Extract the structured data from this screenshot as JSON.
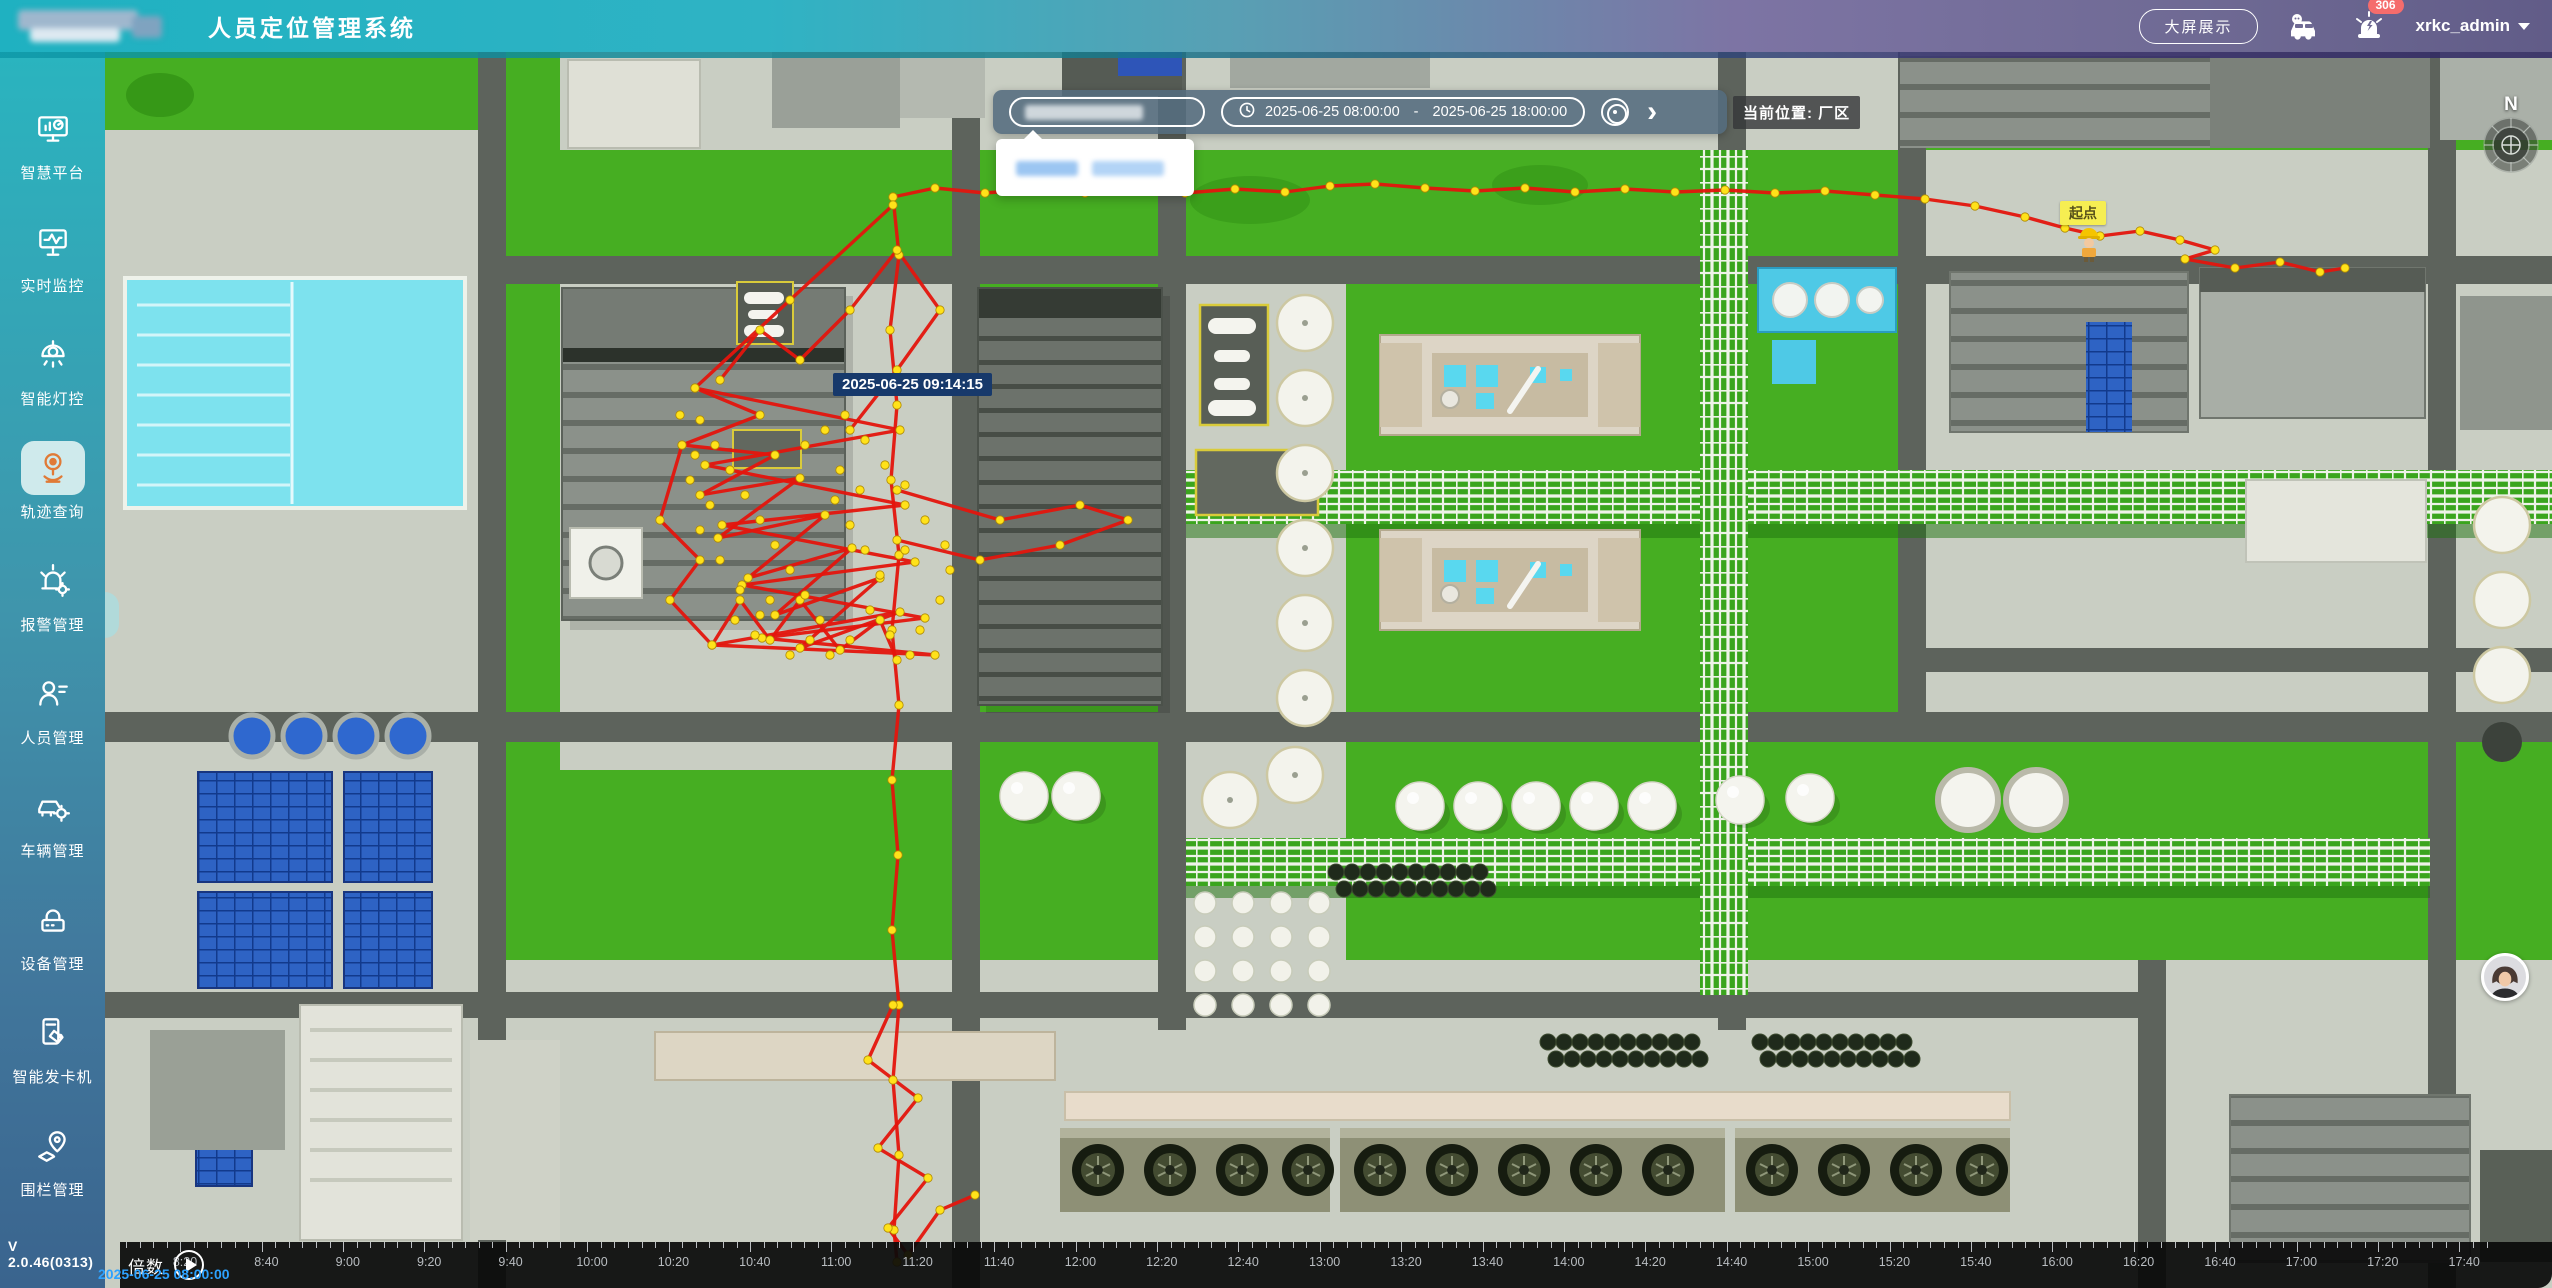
{
  "header": {
    "title": "人员定位管理系统",
    "big_screen_button": "大屏展示",
    "alarm_badge": "306",
    "username": "xrkc_admin"
  },
  "sidebar": {
    "items": [
      {
        "label": "智慧平台",
        "icon": "dashboard-monitor",
        "active": false
      },
      {
        "label": "实时监控",
        "icon": "realtime-monitor",
        "active": false
      },
      {
        "label": "智能灯控",
        "icon": "smart-light",
        "active": false
      },
      {
        "label": "轨迹查询",
        "icon": "track-query",
        "active": true
      },
      {
        "label": "报警管理",
        "icon": "alarm",
        "active": false
      },
      {
        "label": "人员管理",
        "icon": "person",
        "active": false
      },
      {
        "label": "车辆管理",
        "icon": "vehicle",
        "active": false
      },
      {
        "label": "设备管理",
        "icon": "device",
        "active": false
      },
      {
        "label": "智能发卡机",
        "icon": "card-machine",
        "active": false
      },
      {
        "label": "围栏管理",
        "icon": "fence",
        "active": false
      }
    ],
    "version": "V 2.0.46(0313)"
  },
  "toolbar": {
    "date_start": "2025-06-25 08:00:00",
    "date_separator": "-",
    "date_end": "2025-06-25 18:00:00",
    "current_location": "当前位置: 厂区"
  },
  "map": {
    "tooltip_time": "2025-06-25 09:14:15",
    "start_point_label": "起点",
    "compass_label": "N",
    "trajectory": {
      "line_color": "#e4150d",
      "dot_color": "#ffe21a",
      "polylines": [
        [
          [
            893,
            197
          ],
          [
            935,
            188
          ],
          [
            985,
            193
          ],
          [
            1035,
            189
          ],
          [
            1085,
            193
          ],
          [
            1135,
            189
          ],
          [
            1185,
            193
          ],
          [
            1235,
            189
          ],
          [
            1285,
            192
          ],
          [
            1330,
            186
          ],
          [
            1375,
            184
          ],
          [
            1425,
            188
          ],
          [
            1475,
            191
          ],
          [
            1525,
            188
          ],
          [
            1575,
            192
          ],
          [
            1625,
            189
          ],
          [
            1675,
            192
          ],
          [
            1725,
            190
          ],
          [
            1775,
            193
          ],
          [
            1825,
            191
          ],
          [
            1875,
            195
          ],
          [
            1925,
            199
          ],
          [
            1975,
            206
          ],
          [
            2025,
            217
          ],
          [
            2065,
            228
          ],
          [
            2100,
            236
          ],
          [
            2140,
            231
          ],
          [
            2180,
            240
          ],
          [
            2215,
            250
          ],
          [
            2185,
            259
          ],
          [
            2235,
            268
          ],
          [
            2280,
            262
          ],
          [
            2320,
            272
          ],
          [
            2345,
            268
          ]
        ],
        [
          [
            893,
            197
          ],
          [
            899,
            255
          ],
          [
            890,
            330
          ],
          [
            897,
            405
          ],
          [
            891,
            480
          ],
          [
            899,
            555
          ],
          [
            892,
            630
          ],
          [
            899,
            705
          ],
          [
            892,
            780
          ],
          [
            898,
            855
          ],
          [
            892,
            930
          ],
          [
            899,
            1005
          ],
          [
            893,
            1080
          ],
          [
            899,
            1155
          ],
          [
            894,
            1230
          ],
          [
            897,
            1262
          ]
        ],
        [
          [
            893,
            205
          ],
          [
            790,
            300
          ],
          [
            695,
            388
          ],
          [
            760,
            415
          ],
          [
            682,
            445
          ],
          [
            775,
            455
          ],
          [
            700,
            495
          ],
          [
            800,
            478
          ],
          [
            718,
            538
          ],
          [
            825,
            515
          ],
          [
            748,
            578
          ],
          [
            852,
            548
          ],
          [
            775,
            615
          ],
          [
            880,
            578
          ],
          [
            800,
            648
          ],
          [
            900,
            612
          ],
          [
            712,
            645
          ]
        ],
        [
          [
            695,
            388
          ],
          [
            900,
            430
          ],
          [
            705,
            465
          ],
          [
            905,
            505
          ],
          [
            722,
            525
          ],
          [
            915,
            562
          ],
          [
            742,
            585
          ],
          [
            925,
            618
          ],
          [
            762,
            638
          ],
          [
            935,
            655
          ],
          [
            712,
            645
          ]
        ],
        [
          [
            682,
            445
          ],
          [
            660,
            520
          ],
          [
            700,
            560
          ],
          [
            670,
            600
          ],
          [
            712,
            645
          ],
          [
            740,
            600
          ],
          [
            770,
            640
          ],
          [
            800,
            600
          ],
          [
            840,
            650
          ],
          [
            880,
            620
          ],
          [
            897,
            660
          ]
        ],
        [
          [
            850,
            430
          ],
          [
            897,
            370
          ],
          [
            940,
            310
          ],
          [
            897,
            250
          ],
          [
            850,
            310
          ],
          [
            800,
            360
          ],
          [
            760,
            330
          ],
          [
            720,
            380
          ]
        ],
        [
          [
            897,
            490
          ],
          [
            1000,
            520
          ],
          [
            1080,
            505
          ],
          [
            1128,
            520
          ],
          [
            1060,
            545
          ],
          [
            980,
            560
          ],
          [
            897,
            540
          ]
        ],
        [
          [
            893,
            1005
          ],
          [
            868,
            1060
          ],
          [
            918,
            1098
          ],
          [
            878,
            1148
          ],
          [
            928,
            1178
          ],
          [
            888,
            1228
          ],
          [
            908,
            1255
          ],
          [
            940,
            1210
          ],
          [
            975,
            1195
          ]
        ]
      ],
      "extra_dots": [
        [
          700,
          420
        ],
        [
          715,
          445
        ],
        [
          730,
          470
        ],
        [
          745,
          495
        ],
        [
          760,
          520
        ],
        [
          775,
          545
        ],
        [
          790,
          570
        ],
        [
          805,
          595
        ],
        [
          820,
          620
        ],
        [
          835,
          500
        ],
        [
          850,
          525
        ],
        [
          865,
          550
        ],
        [
          880,
          575
        ],
        [
          700,
          530
        ],
        [
          720,
          560
        ],
        [
          740,
          590
        ],
        [
          760,
          615
        ],
        [
          690,
          480
        ],
        [
          710,
          505
        ],
        [
          840,
          470
        ],
        [
          860,
          490
        ],
        [
          805,
          445
        ],
        [
          825,
          430
        ],
        [
          845,
          415
        ],
        [
          865,
          440
        ],
        [
          885,
          465
        ],
        [
          905,
          485
        ],
        [
          870,
          610
        ],
        [
          890,
          635
        ],
        [
          910,
          655
        ],
        [
          680,
          415
        ],
        [
          695,
          455
        ],
        [
          850,
          640
        ],
        [
          830,
          655
        ],
        [
          810,
          640
        ],
        [
          790,
          655
        ],
        [
          770,
          600
        ],
        [
          755,
          635
        ],
        [
          735,
          620
        ],
        [
          940,
          600
        ],
        [
          920,
          630
        ],
        [
          950,
          570
        ],
        [
          905,
          550
        ],
        [
          925,
          520
        ],
        [
          945,
          545
        ]
      ]
    }
  },
  "timeline": {
    "speed_label": "倍数",
    "current_time": "2025-06-25 08:00:00",
    "tick_labels": [
      "8:20",
      "8:40",
      "9:00",
      "9:20",
      "9:40",
      "10:00",
      "10:20",
      "10:40",
      "11:00",
      "11:20",
      "11:40",
      "12:00",
      "12:20",
      "12:40",
      "13:00",
      "13:20",
      "13:40",
      "14:00",
      "14:20",
      "14:40",
      "15:00",
      "15:20",
      "15:40",
      "16:00",
      "16:20",
      "16:40",
      "17:00",
      "17:20",
      "17:40"
    ],
    "first_label_offset": 65,
    "label_spacing": 81.4
  }
}
